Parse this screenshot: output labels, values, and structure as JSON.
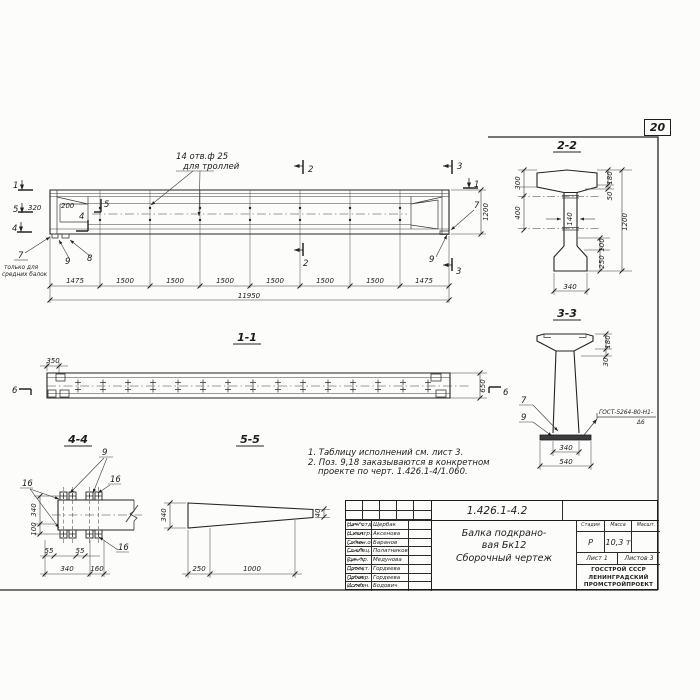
{
  "page": {
    "sheet_number": "20"
  },
  "elevation": {
    "cut_left_1": "1",
    "cut_left_5": "5",
    "cut_left_4": "4",
    "cut_inner_5": "5",
    "cut_inner_4": "4",
    "holes_note_1": "14 отв.ф 25",
    "holes_note_2": "для троллей",
    "dim_320": "320",
    "dim_200": "200",
    "callout_7": "7",
    "callout_7_note_1": "только для",
    "callout_7_note_2": "средних балок",
    "callout_9_left": "9",
    "callout_8": "8",
    "cut_2_top": "2",
    "cut_2_bottom": "2",
    "cut_3_top": "3",
    "cut_3_bottom": "3",
    "cut_1_right": "1",
    "callout_7_right": "7",
    "callout_9_right": "9",
    "dim_height": "1200",
    "segments": [
      "1475",
      "1500",
      "1500",
      "1500",
      "1500",
      "1500",
      "1500",
      "1475"
    ],
    "dim_total": "11950"
  },
  "section22": {
    "title": "2-2",
    "dim_300": "300",
    "dim_400": "400",
    "dim_180": "180",
    "dim_50": "50",
    "dim_1200": "1200",
    "dim_140": "140",
    "dim_100": "100",
    "dim_250": "250",
    "dim_340": "340"
  },
  "section33": {
    "title": "3-3",
    "dim_180": "180",
    "dim_30": "30",
    "dim_340": "340",
    "dim_540": "540",
    "callout_7": "7",
    "callout_9": "9",
    "weld_note_1": "ГОСТ-5264-80-Н1-",
    "weld_note_2": "Δ6"
  },
  "section11": {
    "title": "1-1",
    "dim_350": "350",
    "dim_650": "650",
    "cut_6_left": "6",
    "cut_6_right": "6"
  },
  "section44": {
    "title": "4-4",
    "callout_9": "9",
    "callout_16_left": "16",
    "callout_16_right": "16",
    "callout_16_bottom": "16",
    "dim_340_v": "340",
    "dim_100": "100",
    "dim_55_a": "55",
    "dim_55_b": "55",
    "dim_340_h": "340",
    "dim_160": "160"
  },
  "section55": {
    "title": "5-5",
    "dim_340": "340",
    "dim_40": "40",
    "dim_250": "250",
    "dim_1000": "1000"
  },
  "notes": {
    "line1": "1. Таблицу исполнений  см. лист 3.",
    "line2": "2. Поз. 9,18 заказываются в конкретном",
    "line3": "проекте по черт. 1.426.1-4/1.060."
  },
  "stamp": {
    "doc_number": "1.426.1-4.2",
    "doc_code": "2.000 СБ.",
    "title_line1": "Балка подкрано-",
    "title_line2": "вая Бк12",
    "title_line3": "Сборочный  чертеж",
    "rows": [
      {
        "role": "Нач. отд",
        "name": "Щербак"
      },
      {
        "role": "Н.контр.",
        "name": "Аксенова"
      },
      {
        "role": "Гл.кон.отд",
        "name": "Баранов"
      },
      {
        "role": "Гл.спец.отд",
        "name": "Полатников"
      },
      {
        "role": "Рук. гр.",
        "name": "Медунова"
      },
      {
        "role": "Проект.",
        "name": "Гордеева"
      },
      {
        "role": "Провер.",
        "name": "Гордеева"
      },
      {
        "role": "Исполн.",
        "name": "Бодович"
      }
    ],
    "stage_header": "Стадия",
    "mass_header": "Масса",
    "scale_header": "Масшт.",
    "stage_value": "Р",
    "mass_value": "10,3 т",
    "scale_value": "",
    "sheet_label": "Лист 1",
    "sheets_label": "Листов 3",
    "org_line1": "ГОССТРОЙ СССР",
    "org_line2": "ЛЕНИНГРАДСКИЙ",
    "org_line3": "ПРОМСТРОЙПРОЕКТ"
  }
}
